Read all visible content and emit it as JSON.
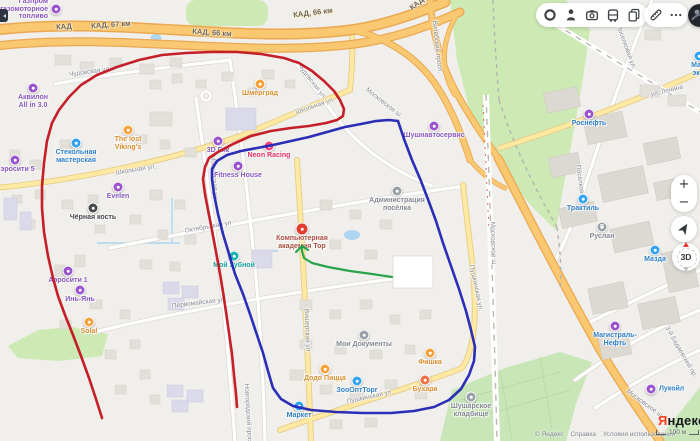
{
  "toolbar": {
    "main_icons": [
      "traffic-icon",
      "panoramas-icon",
      "mirrors-icon",
      "transport-icon",
      "bookmarks-icon"
    ],
    "edit_icons": [
      "ruler-icon",
      "more-icon"
    ]
  },
  "map_controls": {
    "zoom_in_label": "+",
    "zoom_out_label": "−",
    "compass_label": "3D"
  },
  "attribution": {
    "logo_ya": "Я",
    "logo_rest": "ндекс",
    "copyright": "© Яндекс",
    "help": "Справка",
    "terms": "Условия использования",
    "scale_label": "100 м"
  },
  "map": {
    "kad_labels": [
      {
        "text": "КАД",
        "x": 64,
        "y": 27,
        "rot": -4
      },
      {
        "text": "КАД, 67 км",
        "x": 111,
        "y": 25,
        "rot": -4
      },
      {
        "text": "КАД, 66 км",
        "x": 212,
        "y": 33,
        "rot": 4
      },
      {
        "text": "КАД, 66 км",
        "x": 313,
        "y": 13,
        "rot": -7
      },
      {
        "text": "КАД",
        "x": 417,
        "y": 4,
        "rot": -38
      }
    ],
    "street_labels": [
      {
        "text": "Чудовская ул.",
        "x": 90,
        "y": 72,
        "rot": -8
      },
      {
        "text": "Чудовская ул.",
        "x": 312,
        "y": 82,
        "rot": 52
      },
      {
        "text": "Школьная ул.",
        "x": 136,
        "y": 170,
        "rot": -9
      },
      {
        "text": "Школьная ул.",
        "x": 315,
        "y": 106,
        "rot": -19
      },
      {
        "text": "Московская ул.",
        "x": 214,
        "y": 178,
        "rot": 86
      },
      {
        "text": "Октябрьская ул.",
        "x": 209,
        "y": 227,
        "rot": -10
      },
      {
        "text": "Первомайская ул.",
        "x": 199,
        "y": 303,
        "rot": -7
      },
      {
        "text": "Вишерская ул.",
        "x": 307,
        "y": 331,
        "rot": 88
      },
      {
        "text": "Пушкинская ул.",
        "x": 476,
        "y": 288,
        "rot": 78
      },
      {
        "text": "Пушкинская ул.",
        "x": 370,
        "y": 397,
        "rot": -12
      },
      {
        "text": "Витебский просп.",
        "x": 437,
        "y": 47,
        "rot": 84
      },
      {
        "text": "Московское ш.",
        "x": 384,
        "y": 103,
        "rot": 38
      },
      {
        "text": "Московское ш.",
        "x": 493,
        "y": 244,
        "rot": 88
      },
      {
        "text": "Московское ш.",
        "x": 645,
        "y": 404,
        "rot": 36
      },
      {
        "text": "ул. Ленина",
        "x": 667,
        "y": 91,
        "rot": -14
      },
      {
        "text": "Поселковая ул.",
        "x": 626,
        "y": 47,
        "rot": 70
      },
      {
        "text": "Поселковая ул.",
        "x": 581,
        "y": 188,
        "rot": 82
      },
      {
        "text": "3-й Бадаевский пр.",
        "x": 681,
        "y": 352,
        "rot": 60
      },
      {
        "text": "Новгородский просп.",
        "x": 248,
        "y": 415,
        "rot": 87
      }
    ],
    "pois": [
      {
        "lines": [
          "Газпром",
          "газомоторное",
          "топливо"
        ],
        "x": 56,
        "y": 9,
        "c": "#9a53cd",
        "tc": "#8757bb",
        "layout": "left"
      },
      {
        "lines": [
          "Аквилон",
          "All in 3.0"
        ],
        "x": 33,
        "y": 88,
        "c": "#9a53cd",
        "tc": "#8757bb"
      },
      {
        "lines": [
          "Аэросити 5"
        ],
        "x": 15,
        "y": 160,
        "c": "#9a53cd",
        "tc": "#8757bb"
      },
      {
        "lines": [
          "Стекольная",
          "мастерская"
        ],
        "x": 76,
        "y": 143,
        "c": "#33a3f0",
        "tc": "#2e7fc6"
      },
      {
        "lines": [
          "The lost",
          "Viking's"
        ],
        "x": 128,
        "y": 130,
        "c": "#f5a23b",
        "tc": "#d88d2e"
      },
      {
        "lines": [
          "Шмерград"
        ],
        "x": 260,
        "y": 84,
        "c": "#f5a23b",
        "tc": "#d88d2e"
      },
      {
        "lines": [
          "Evelen"
        ],
        "x": 118,
        "y": 187,
        "c": "#9a53cd",
        "tc": "#8757bb"
      },
      {
        "lines": [
          "Чёрная кость"
        ],
        "x": 93,
        "y": 208,
        "c": "#44474c",
        "tc": "#43464b"
      },
      {
        "lines": [
          "3D Гик"
        ],
        "x": 218,
        "y": 141,
        "c": "#9a53cd",
        "tc": "#8757bb"
      },
      {
        "lines": [
          "Neon Racing"
        ],
        "x": 269,
        "y": 146,
        "c": "#f2467c",
        "tc": "#e52e62"
      },
      {
        "lines": [
          "Fitness House"
        ],
        "x": 238,
        "y": 166,
        "c": "#9a53cd",
        "tc": "#8757bb"
      },
      {
        "lines": [
          "Мой Зубной"
        ],
        "x": 234,
        "y": 256,
        "c": "#19b3b0",
        "tc": "#119e9b"
      },
      {
        "lines": [
          "Компьютерная",
          "академия Тор"
        ],
        "x": 302,
        "y": 229,
        "c": "#e23d2e",
        "tc": "#a94f43",
        "big": true
      },
      {
        "lines": [
          "Администрация",
          "посёлка"
        ],
        "x": 397,
        "y": 191,
        "c": "#98a0a8",
        "tc": "#828890"
      },
      {
        "lines": [
          "Мои Документы"
        ],
        "x": 364,
        "y": 335,
        "c": "#98a0a8",
        "tc": "#828890"
      },
      {
        "lines": [
          "Додо Пицца"
        ],
        "x": 325,
        "y": 369,
        "c": "#f5a23b",
        "tc": "#d88d2e"
      },
      {
        "lines": [
          "ЗооОптТорг"
        ],
        "x": 357,
        "y": 381,
        "c": "#33a3f0",
        "tc": "#2e7fc6"
      },
      {
        "lines": [
          "Фишка"
        ],
        "x": 430,
        "y": 353,
        "c": "#f5a23b",
        "tc": "#d88d2e"
      },
      {
        "lines": [
          "Бухара"
        ],
        "x": 425,
        "y": 380,
        "c": "#ef7146",
        "tc": "#d88d2e"
      },
      {
        "lines": [
          "Шушарское",
          "кладбище"
        ],
        "x": 471,
        "y": 397,
        "c": "#98a0a8",
        "tc": "#828890"
      },
      {
        "lines": [
          "Маркет"
        ],
        "x": 299,
        "y": 406,
        "c": "#33a3f0",
        "tc": "#2e7fc6"
      },
      {
        "lines": [
          "Роснефть"
        ],
        "x": 589,
        "y": 114,
        "c": "#9a53cd",
        "tc": "#2e7fc6"
      },
      {
        "lines": [
          "Трактиль"
        ],
        "x": 583,
        "y": 199,
        "c": "#33a3f0",
        "tc": "#2e7fc6"
      },
      {
        "lines": [
          "Руслан"
        ],
        "x": 602,
        "y": 227,
        "c": "#98a0a8",
        "tc": "#828890",
        "glyph": "P"
      },
      {
        "lines": [
          "Магистраль-",
          "Нефть"
        ],
        "x": 615,
        "y": 326,
        "c": "#9a53cd",
        "tc": "#2e7fc6"
      },
      {
        "lines": [
          "Лукойл"
        ],
        "x": 651,
        "y": 389,
        "c": "#9a53cd",
        "tc": "#2e7fc6",
        "layout": "right"
      },
      {
        "lines": [
          "Мазда"
        ],
        "x": 655,
        "y": 250,
        "c": "#33a3f0",
        "tc": "#2e7fc6"
      },
      {
        "lines": [
          "Ма...",
          "эк..."
        ],
        "x": 699,
        "y": 56,
        "c": "#33a3f0",
        "tc": "#2e7fc6"
      },
      {
        "lines": [
          "Шушнавтосервис"
        ],
        "x": 434,
        "y": 126,
        "c": "#9a53cd",
        "tc": "#8757bb"
      },
      {
        "lines": [
          "Инь-Янь"
        ],
        "x": 80,
        "y": 290,
        "c": "#9a53cd",
        "tc": "#8757bb"
      },
      {
        "lines": [
          "Аэросити 1"
        ],
        "x": 68,
        "y": 271,
        "c": "#9a53cd",
        "tc": "#8757bb"
      },
      {
        "lines": [
          "Solal"
        ],
        "x": 89,
        "y": 322,
        "c": "#f5a23b",
        "tc": "#d88d2e"
      }
    ]
  },
  "annotations": {
    "red": {
      "color": "#c2131f",
      "width": 2.6,
      "points": [
        [
          102,
          418
        ],
        [
          96,
          399
        ],
        [
          89,
          378
        ],
        [
          81,
          356
        ],
        [
          73,
          335
        ],
        [
          65,
          315
        ],
        [
          58,
          296
        ],
        [
          53,
          278
        ],
        [
          48,
          256
        ],
        [
          44,
          232
        ],
        [
          42,
          208
        ],
        [
          42,
          186
        ],
        [
          44,
          163
        ],
        [
          47,
          141
        ],
        [
          52,
          123
        ],
        [
          59,
          110
        ],
        [
          69,
          97
        ],
        [
          81,
          85
        ],
        [
          97,
          75
        ],
        [
          117,
          67
        ],
        [
          139,
          60
        ],
        [
          162,
          55
        ],
        [
          186,
          53
        ],
        [
          211,
          52
        ],
        [
          237,
          52
        ],
        [
          261,
          54
        ],
        [
          284,
          58
        ],
        [
          299,
          63
        ],
        [
          312,
          71
        ],
        [
          324,
          81
        ],
        [
          334,
          91
        ],
        [
          340,
          100
        ],
        [
          344,
          109
        ],
        [
          343,
          116
        ],
        [
          337,
          120
        ],
        [
          326,
          123
        ],
        [
          309,
          126
        ],
        [
          291,
          128
        ],
        [
          271,
          131
        ],
        [
          251,
          136
        ],
        [
          233,
          144
        ],
        [
          218,
          152
        ],
        [
          209,
          158
        ],
        [
          205,
          167
        ],
        [
          203,
          179
        ],
        [
          205,
          194
        ],
        [
          208,
          210
        ],
        [
          211,
          225
        ],
        [
          214,
          241
        ],
        [
          217,
          257
        ],
        [
          220,
          274
        ],
        [
          223,
          292
        ],
        [
          226,
          312
        ],
        [
          229,
          333
        ],
        [
          232,
          354
        ],
        [
          234,
          375
        ],
        [
          236,
          394
        ],
        [
          237,
          407
        ]
      ]
    },
    "blue": {
      "color": "#2023b4",
      "width": 2.6,
      "points": [
        [
          398,
          121
        ],
        [
          404,
          139
        ],
        [
          412,
          160
        ],
        [
          421,
          181
        ],
        [
          429,
          202
        ],
        [
          436,
          221
        ],
        [
          443,
          243
        ],
        [
          451,
          266
        ],
        [
          459,
          289
        ],
        [
          466,
          311
        ],
        [
          471,
          330
        ],
        [
          475,
          347
        ],
        [
          474,
          361
        ],
        [
          469,
          375
        ],
        [
          461,
          389
        ],
        [
          449,
          400
        ],
        [
          434,
          407
        ],
        [
          414,
          411
        ],
        [
          391,
          413
        ],
        [
          363,
          413
        ],
        [
          336,
          412
        ],
        [
          311,
          410
        ],
        [
          293,
          406
        ],
        [
          281,
          399
        ],
        [
          273,
          388
        ],
        [
          268,
          371
        ],
        [
          263,
          353
        ],
        [
          257,
          335
        ],
        [
          250,
          314
        ],
        [
          243,
          294
        ],
        [
          235,
          274
        ],
        [
          229,
          254
        ],
        [
          223,
          234
        ],
        [
          218,
          214
        ],
        [
          214,
          194
        ],
        [
          212,
          179
        ],
        [
          212,
          169
        ],
        [
          217,
          161
        ],
        [
          227,
          155
        ],
        [
          241,
          151
        ],
        [
          257,
          148
        ],
        [
          273,
          145
        ],
        [
          291,
          141
        ],
        [
          309,
          137
        ],
        [
          327,
          132
        ],
        [
          345,
          127
        ],
        [
          361,
          124
        ],
        [
          376,
          121
        ],
        [
          389,
          120
        ],
        [
          398,
          121
        ]
      ]
    },
    "green": {
      "color": "#1fa044",
      "width": 2.2,
      "points": [
        [
          392,
          277
        ],
        [
          372,
          274
        ],
        [
          350,
          271
        ],
        [
          328,
          267
        ],
        [
          312,
          263
        ],
        [
          304,
          258
        ],
        [
          302,
          251
        ],
        [
          302,
          246
        ]
      ],
      "arrow": [
        [
          [
            302,
            246
          ],
          [
            296,
            252
          ]
        ],
        [
          [
            302,
            246
          ],
          [
            308,
            250
          ]
        ]
      ]
    }
  }
}
